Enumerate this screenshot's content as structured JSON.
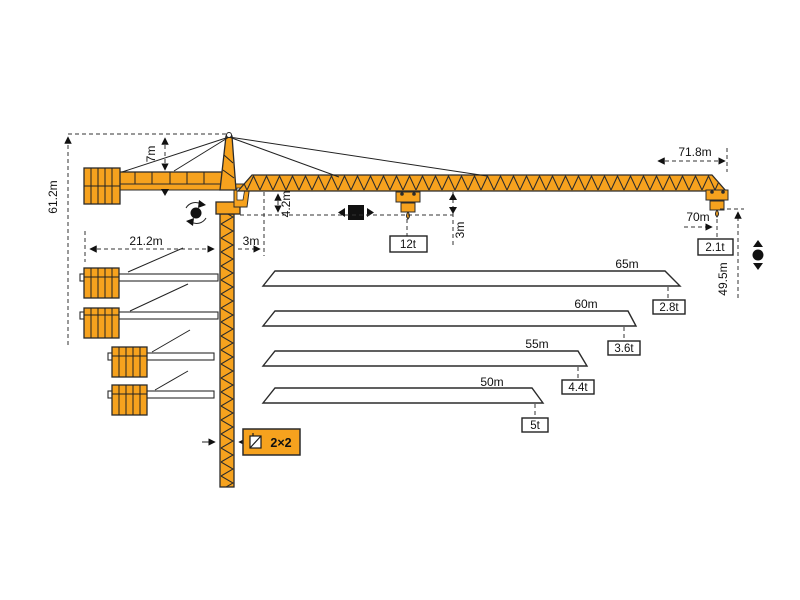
{
  "diagram_title": "tower-crane-load-diagram",
  "colors": {
    "crane_orange": "#F6A21E",
    "outline": "#2B2B2B",
    "dim_line": "#333333",
    "background": "#FFFFFF"
  },
  "labels": {
    "total_height": "61.2m",
    "top_above_jib": "7m",
    "counter_radius": "21.2m",
    "min_radius": "3m",
    "jib_depth": "4.2m",
    "hook_to_jib": "3m",
    "max_capacity": "12t",
    "max_radius": "71.8m",
    "tip_radius": "70m",
    "tip_capacity": "2.1t",
    "hook_height": "49.5m",
    "mast_section": "2×2"
  },
  "jib_options": [
    {
      "length": "65m",
      "tip_load": "2.8t"
    },
    {
      "length": "60m",
      "tip_load": "3.6t"
    },
    {
      "length": "55m",
      "tip_load": "4.4t"
    },
    {
      "length": "50m",
      "tip_load": "5t"
    }
  ],
  "icons": {
    "slewing": "slewing-rotation",
    "trolley": "trolley-travel",
    "hoisting": "hook-hoisting",
    "mast_section": "mast-cross-section"
  }
}
